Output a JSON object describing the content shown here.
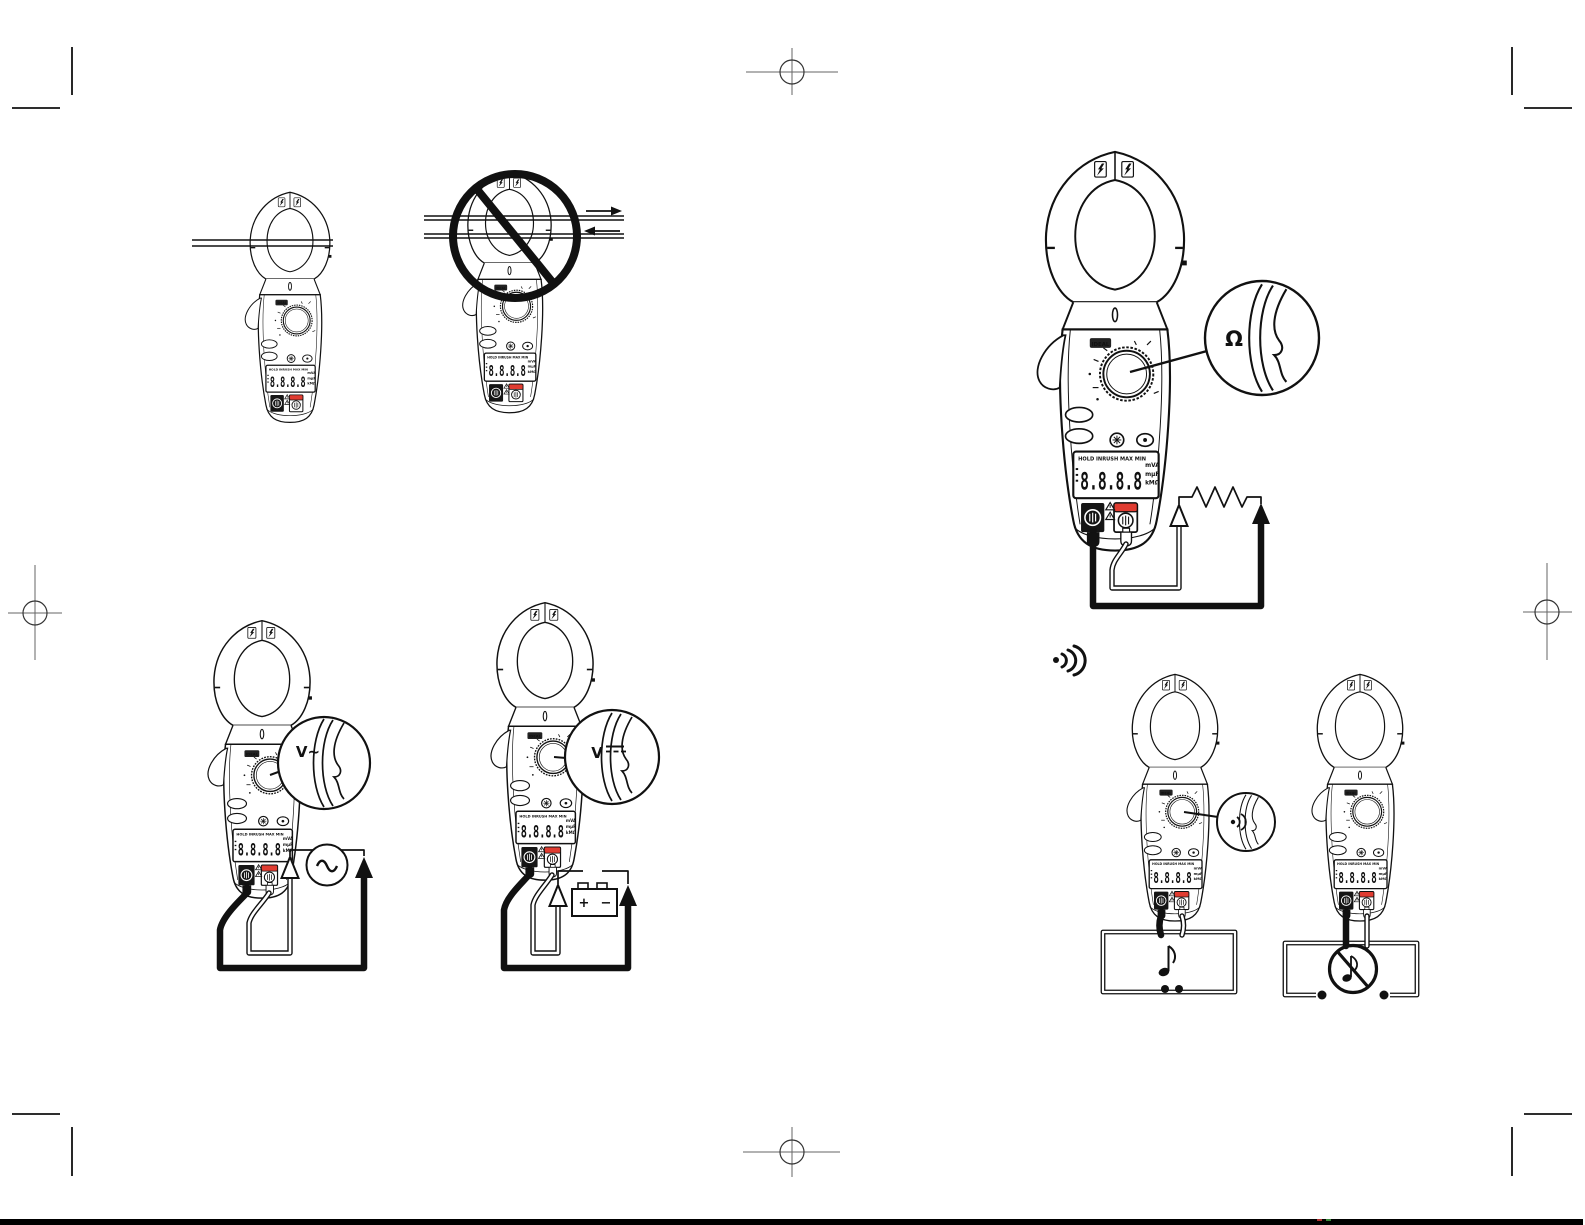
{
  "document": {
    "kind": "clamp-meter instruction manual diagram page",
    "background": "#ffffff"
  },
  "meter": {
    "logo": "IDEAL",
    "display": {
      "annunciators": "HOLD INRUSH MAX MIN",
      "digits": "8.8.8.8",
      "unit_rows": [
        "mVA",
        "mμF",
        "kMΩ"
      ]
    }
  },
  "callouts": {
    "resistance": "Ω",
    "ac_voltage": "V~",
    "dc_voltage": "V"
  },
  "battery": {
    "plus": "+",
    "minus": "−"
  },
  "figures": {
    "top_left": "clamp jaw around single conductor",
    "top_left_2": "clamp jaw around two conductors - prohibited",
    "right_top": "resistance measurement with resistor circuit",
    "bottom_left_1": "AC voltage measurement with AC source",
    "bottom_left_2": "DC voltage measurement with battery",
    "bottom_right_1": "continuity test - beeper sounds (music note)",
    "bottom_right_2": "continuity test - open circuit, no beep (crossed music note)"
  },
  "icons": [
    "lightning-bolt-icon",
    "warning-triangle-icon",
    "prohibition-circle-icon",
    "current-arrow-right-icon",
    "current-arrow-left-icon",
    "ac-source-icon",
    "dc-symbol-icon",
    "resistor-icon",
    "continuity-beeper-icon",
    "sound-waves-icon",
    "music-note-icon",
    "music-note-crossed-icon",
    "backlight-button-icon",
    "registration-target-icon",
    "crop-mark-icon"
  ],
  "colors": {
    "ink": "#111111",
    "terminal_red": "#e03c31",
    "bottom_bar": "#000000"
  }
}
